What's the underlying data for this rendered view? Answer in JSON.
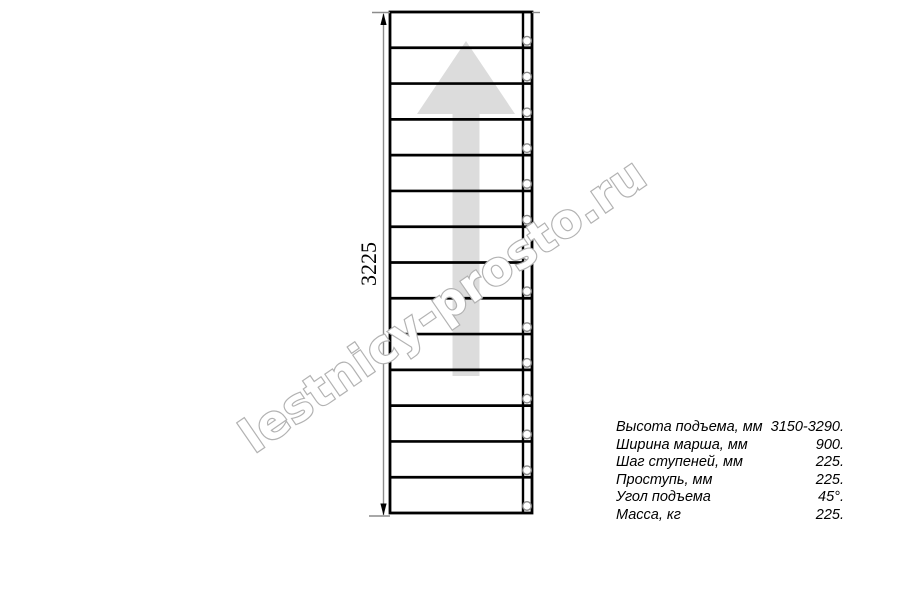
{
  "diagram": {
    "dimension_label": "3225",
    "treads": 14,
    "colors": {
      "line": "#000000",
      "dimension": "#8c8c8c",
      "arrow_fill": "#dcdcdc",
      "circle_stroke": "#8a8a8a",
      "watermark_stroke": "#b2b2b2",
      "text": "#000000"
    }
  },
  "watermark": {
    "text": "lestnicy-prosto.ru"
  },
  "spec_table": {
    "rows": [
      {
        "label": "Высота подъема, мм",
        "value": "3150-3290."
      },
      {
        "label": "Ширина марша, мм",
        "value": "900."
      },
      {
        "label": "Шаг ступеней, мм",
        "value": "225."
      },
      {
        "label": "Проступь, мм",
        "value": "225."
      },
      {
        "label": "Угол подъема",
        "value": "45°."
      },
      {
        "label": "Масса, кг",
        "value": "225."
      }
    ]
  }
}
